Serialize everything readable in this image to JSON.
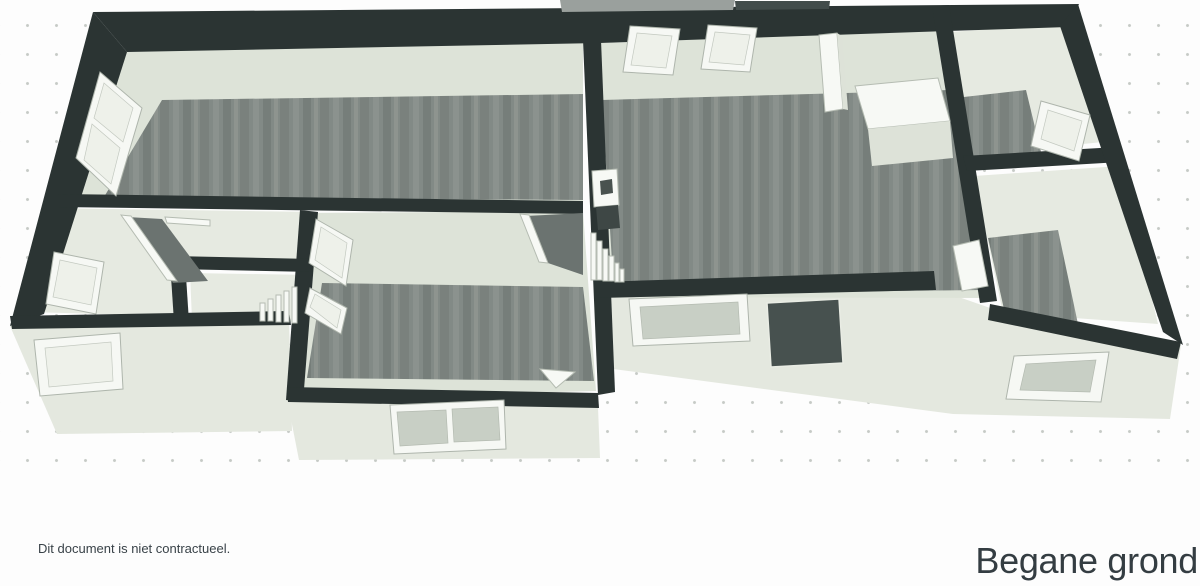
{
  "document": {
    "disclaimer_text": "Dit document is niet contractueel.",
    "floor_title": "Begane grond"
  },
  "palette": {
    "background": "#fdfdfd",
    "dot": "#c6cac6",
    "wall_dark": "#2b3433",
    "wall_dark_light": "#424c4b",
    "wall_top_gray": "#9aa09d",
    "face_light": "#e4e8df",
    "face_shade": "#dde2d8",
    "wall_back": "#dde3d8",
    "floor_light": "#e6eae1",
    "window_frame": "#f6f8f4",
    "pane_light": "#eef1ea",
    "pane_gray": "#c8cfc5",
    "door_dark": "#47514f",
    "hall_dark": "#6b7370",
    "text_primary": "#394248",
    "text_title": "#343d42"
  },
  "scene": {
    "type": "floorplan-3d-overview",
    "elements": [
      "outer-walls",
      "interior-walls",
      "wood-floors",
      "light-floors",
      "windows",
      "front-door",
      "staircase",
      "toilet",
      "cabinet",
      "door-panels",
      "dot-grid"
    ]
  }
}
